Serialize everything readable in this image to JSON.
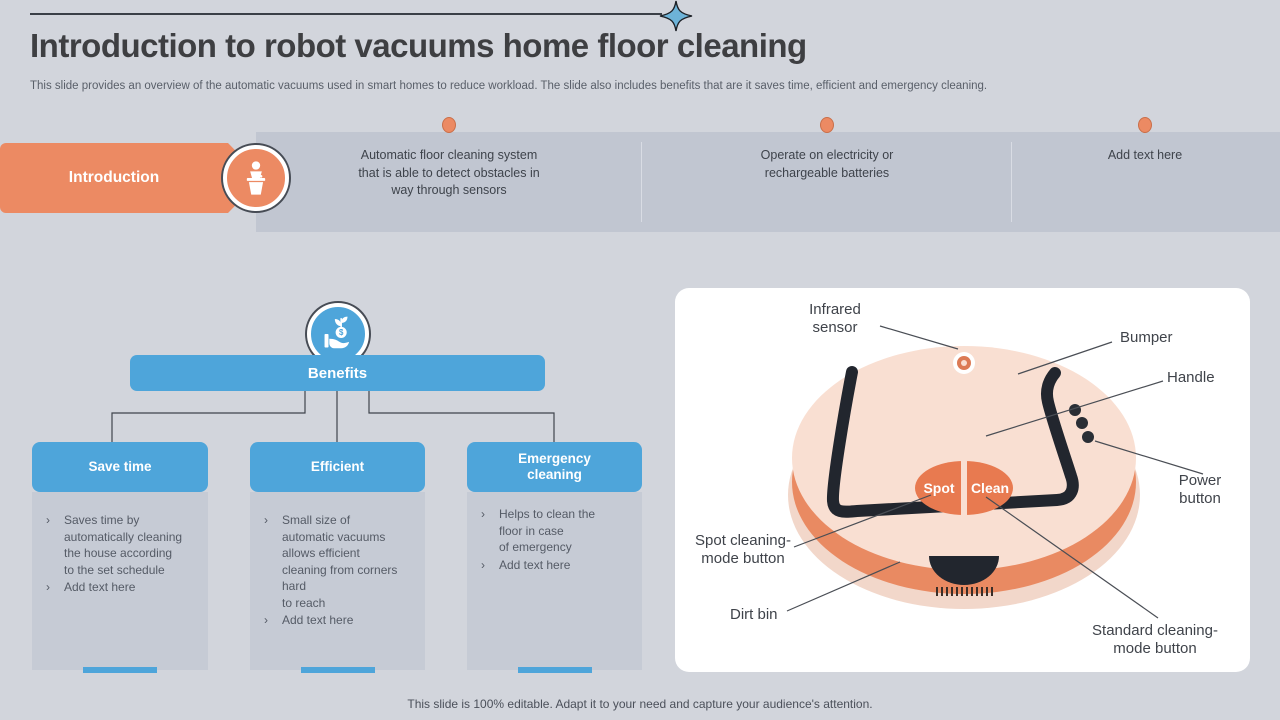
{
  "slide": {
    "title": "Introduction to robot vacuums home floor cleaning",
    "subtitle": "This slide provides an overview of the automatic vacuums used in smart homes to reduce workload. The slide also includes benefits that are it saves time, efficient and emergency cleaning.",
    "footer": "This slide is 100% editable. Adapt it to your need and capture your audience's attention.",
    "bullet_char": "›"
  },
  "timeline": {
    "label": "Introduction",
    "items": [
      {
        "text": "Automatic floor cleaning system\nthat is able to detect obstacles in\nway through sensors"
      },
      {
        "text": "Operate on electricity or\nrechargeable batteries"
      },
      {
        "text": "Add text here"
      }
    ]
  },
  "benefits": {
    "title": "Benefits",
    "columns": [
      {
        "title": "Save time",
        "bullets": [
          "Saves time by\nautomatically cleaning\nthe house according\nto the set schedule",
          "Add text here"
        ]
      },
      {
        "title": "Efficient",
        "bullets": [
          "Small size of\nautomatic vacuums\nallows efficient\ncleaning from corners\nhard\nto reach",
          "Add text here"
        ]
      },
      {
        "title": "Emergency cleaning",
        "bullets": [
          "Helps to clean the\nfloor in case\nof emergency",
          "Add text here"
        ]
      }
    ]
  },
  "diagram": {
    "buttons": {
      "spot": "Spot",
      "clean": "Clean"
    },
    "labels": {
      "infrared": "Infrared\nsensor",
      "bumper": "Bumper",
      "handle": "Handle",
      "power": "Power\nbutton",
      "spot_mode": "Spot cleaning-\nmode button",
      "dirt_bin": "Dirt bin",
      "standard_mode": "Standard cleaning-\nmode button"
    }
  },
  "icons": {
    "star": "four-point-star-icon",
    "intro": "presenter-podium-icon",
    "benefits": "hand-coin-sprout-icon"
  },
  "colors": {
    "accent_orange": "#EC8A63",
    "accent_blue": "#4EA5DA",
    "slide_bg": "#D2D5DC",
    "band_bg": "#C1C6D1",
    "column_bg": "#C6CBD5",
    "robot_body": "#F9DFD2",
    "robot_rim": "#E98A62",
    "handle_black": "#22262E",
    "ink": "#3F444C"
  }
}
